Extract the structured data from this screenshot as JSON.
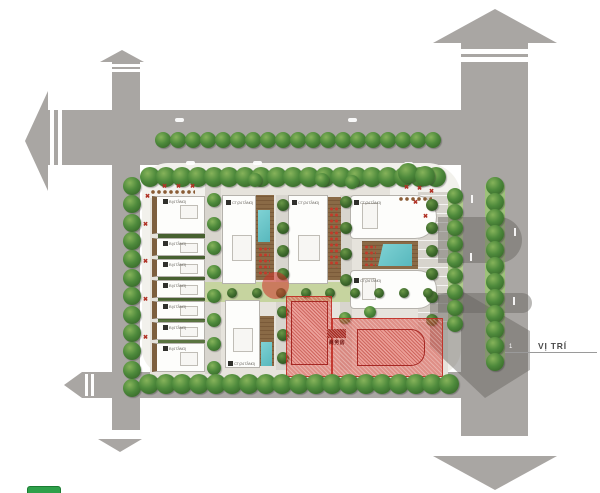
{
  "annotations": {
    "location_label": "VỊ TRÍ",
    "location_marker": "1",
    "red_area_label": "商务房"
  },
  "buildings": {
    "tower_badge_label": "CT (24 TẦNG)",
    "rowhouse_badge_label": "B (4 TẦNG)"
  },
  "colors": {
    "road": "#a9a6a3",
    "site_paving": "#e6e3dc",
    "tree_green": "#4e8a3c",
    "lawn": "#c6d49f",
    "pool": "#6ac6ca",
    "terrace": "#8a6a46",
    "red_overlay": "#d7372e",
    "legend_green": "#2ea04a",
    "shadow": "#6e6b68"
  }
}
